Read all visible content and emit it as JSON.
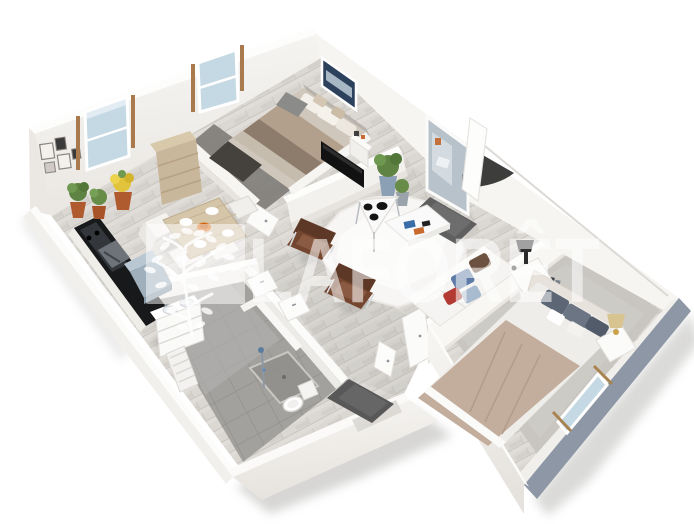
{
  "watermark": {
    "brand": "LAFORÊT",
    "logo": "tree-in-square-logo",
    "color": "#ffffff",
    "opacity": 0.55
  },
  "scene": {
    "type": "isometric-3d-floor-plan",
    "style": "white walls, whitewashed oak floor, photoreal render on white background",
    "rooms": [
      {
        "id": "kitchen-dining",
        "furniture": [
          "black-kitchen-counter",
          "steel-oven",
          "appliance-cabinet",
          "dining-table",
          "dining-chairs",
          "place-settings",
          "fruit-bowl",
          "potted-plants",
          "picture-frames"
        ]
      },
      {
        "id": "bedroom-1",
        "furniture": [
          "double-bed-striped-bedding",
          "dark-throw",
          "grey-bench",
          "wall-art",
          "tv-on-half-wall",
          "wood-wardrobe",
          "dark-rug"
        ]
      },
      {
        "id": "living-room",
        "furniture": [
          "white-sofa-with-pillows",
          "brown-leather-armchair",
          "brown-leather-armchair",
          "white-coffee-table",
          "books",
          "triangular-side-table",
          "black-bowls",
          "fluffy-white-rug",
          "floor-plants",
          "storage-basket"
        ]
      },
      {
        "id": "entry",
        "furniture": [
          "mirrored-front-door",
          "open-door-leaf",
          "dark-doormat",
          "console-table"
        ]
      },
      {
        "id": "bathroom",
        "furniture": [
          "double-vanity",
          "towel-radiator",
          "walk-in-shower",
          "toilet",
          "interior-door",
          "interior-door"
        ]
      },
      {
        "id": "hallway",
        "furniture": [
          "dark-doormat",
          "open-door-leaf"
        ]
      },
      {
        "id": "bedroom-2",
        "furniture": [
          "double-bed-taupe-blanket",
          "padded-headboard",
          "nightstand-with-lamp",
          "nightstand-with-lamp",
          "grey-rug",
          "window-with-curtain-rods"
        ]
      }
    ],
    "windows_count": 3,
    "background": "#ffffff"
  },
  "colors": {
    "background": "#ffffff",
    "wall": "#f7f6f3",
    "wall_top": "#fdfdfc",
    "wall_shade": "#eceae6",
    "wall_exterior_blue": "#8d97a5",
    "wood_floor": "#dbd8d3",
    "plank_line": "#c8c4bf",
    "tile_floor": "#a3a19e",
    "tile_dark": "#95938f",
    "tile_light": "#b7b5b2",
    "rug_living": "#f7f6f4",
    "rug_bedroom2": "#c9c6c1",
    "rug_bedroom1": "#7e7b77",
    "window_glass": "#c5d9e4",
    "curtain_rod": "#a87a4e",
    "counter_black": "#17191b",
    "appliance_steel": "#6d7378",
    "cabinet_blue": "#9fb0bc",
    "table_wood": "#d5c5a9",
    "wardrobe_wood": "#c9b79b",
    "armchair_brown": "#74462f",
    "sofa_white": "#f5f4f2",
    "pillow_blue": "#5e7ba8",
    "pillow_red": "#b23a33",
    "pillow_brown": "#6d5140",
    "pillow_light_blue": "#a9bccf",
    "bed2_blanket": "#c3ad9c",
    "bed2_sheet": "#efedea",
    "bed2_pillow_grey": "#5d6675",
    "bed1_stripe_a": "#b2a08d",
    "bed1_stripe_b": "#8d7c6b",
    "bed1_throw": "#45423d",
    "tv_black": "#121212",
    "wall_art_navy": "#2c415c",
    "plant_green": "#5f8342",
    "plant_yellow": "#e2c33c",
    "pot_terracotta": "#b05a30",
    "pot_blue": "#8ba0b5",
    "doormat_dark": "#5f5f5f",
    "door_shadow": "#2d2d2d",
    "mirror": "#b7c2ca"
  }
}
